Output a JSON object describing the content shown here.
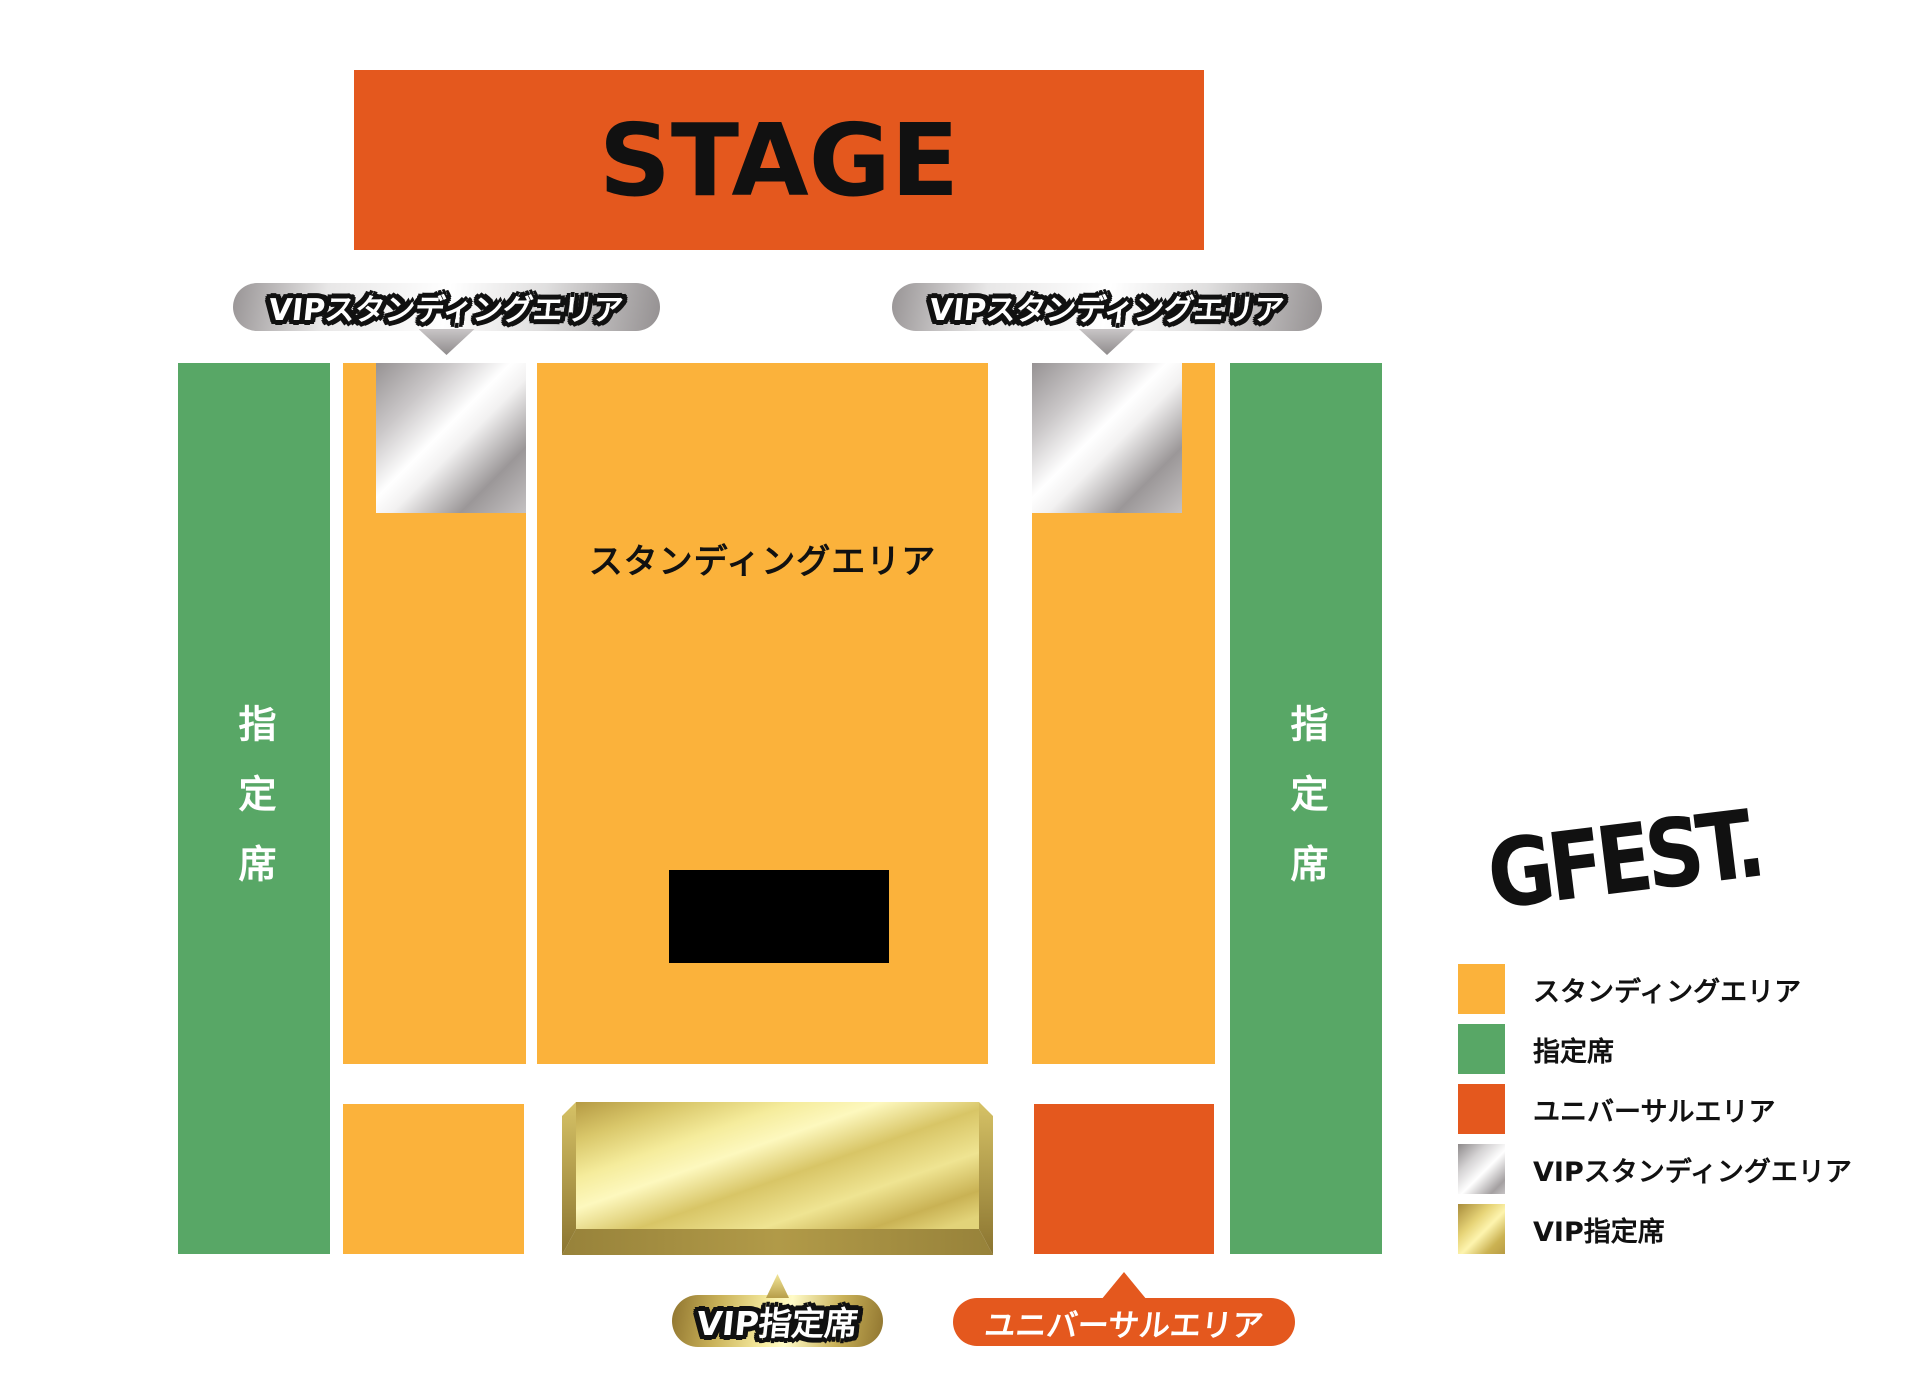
{
  "stage": {
    "label": "STAGE"
  },
  "map": {
    "standing_area_label": "スタンディングエリア",
    "reserved_left_label": "指定席",
    "reserved_right_label": "指定席",
    "vip_standing_callout_left": "VIPスタンディングエリア",
    "vip_standing_callout_right": "VIPスタンディングエリア",
    "vip_reserved_callout": "VIP指定席",
    "universal_callout": "ユニバーサルエリア"
  },
  "legend": {
    "items": [
      {
        "label": "スタンディングエリア",
        "swatch": "standing",
        "color": "#FBB23B"
      },
      {
        "label": "指定席",
        "swatch": "reserved",
        "color": "#58A766"
      },
      {
        "label": "ユニバーサルエリア",
        "swatch": "universal",
        "color": "#E4581E"
      },
      {
        "label": "VIPスタンディングエリア",
        "swatch": "vip-standing",
        "color": "silver-gradient"
      },
      {
        "label": "VIP指定席",
        "swatch": "vip-reserved",
        "color": "gold-gradient"
      }
    ]
  },
  "logo": {
    "text": "GFEST."
  },
  "colors": {
    "standing": "#FBB23B",
    "reserved": "#58A766",
    "stage": "#E4581E",
    "universal": "#E4581E",
    "silver_dark": "#8F8B8C",
    "gold_dark": "#8F742F",
    "background": "#FFFFFF",
    "text_dark": "#111111",
    "text_light": "#FFFFFF"
  }
}
